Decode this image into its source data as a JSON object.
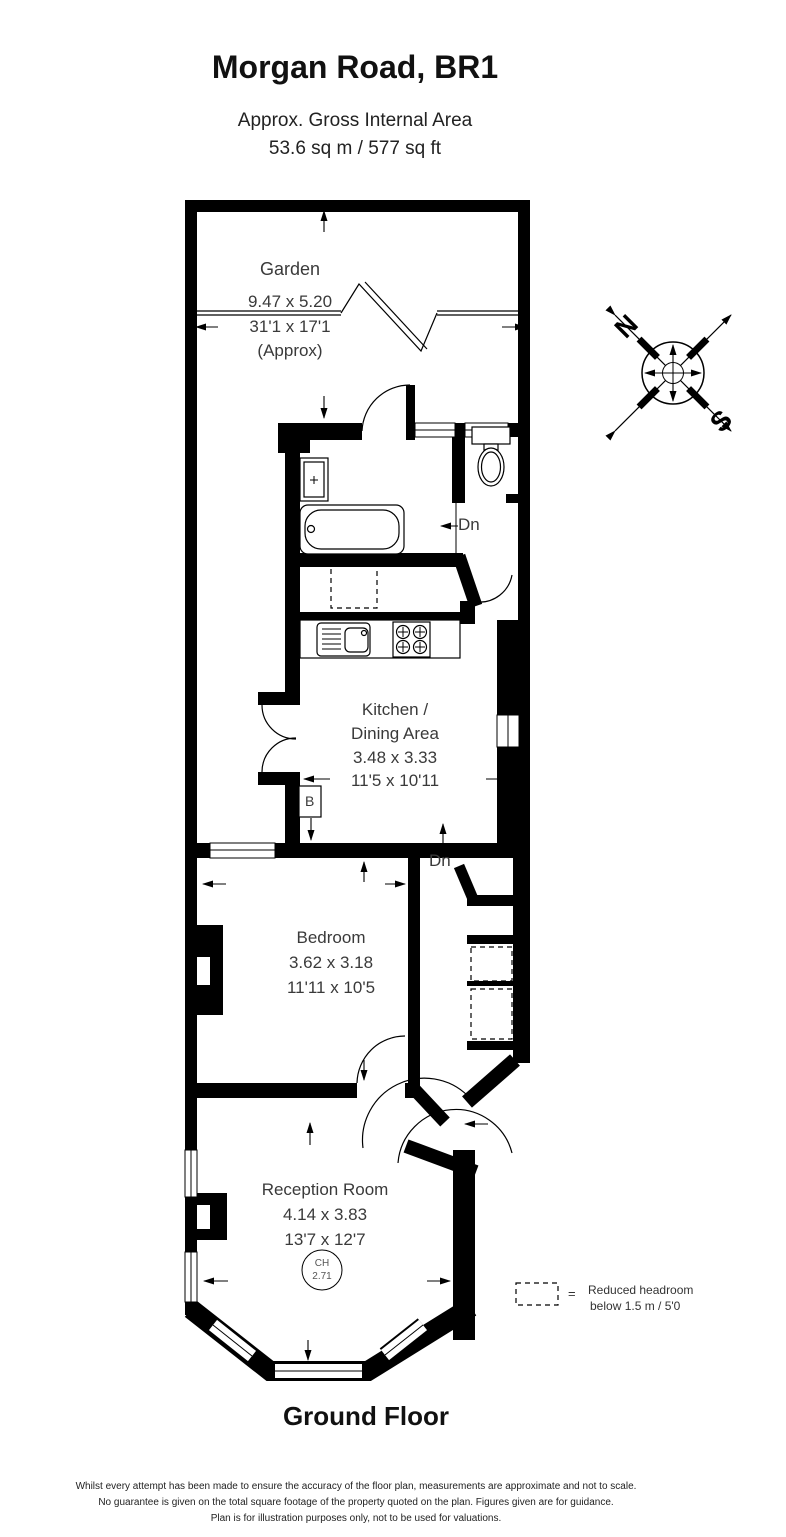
{
  "title": {
    "address": "Morgan Road, BR1",
    "area_label": "Approx. Gross Internal Area",
    "area_value": "53.6 sq m / 577 sq ft"
  },
  "rooms": {
    "garden": {
      "name": "Garden",
      "metric": "9.47 x 5.20",
      "imperial": "31'1 x 17'1",
      "note": "(Approx)"
    },
    "kitchen": {
      "name_line1": "Kitchen /",
      "name_line2": "Dining Area",
      "metric": "3.48 x 3.33",
      "imperial": "11'5 x 10'11"
    },
    "bedroom": {
      "name": "Bedroom",
      "metric": "3.62 x 3.18",
      "imperial": "11'11 x 10'5"
    },
    "reception": {
      "name": "Reception Room",
      "metric": "4.14 x 3.83",
      "imperial": "13'7 x 12'7"
    }
  },
  "annotations": {
    "down_upper": "Dn",
    "down_lower": "Dn",
    "boiler": "B",
    "ceiling_height_label": "CH",
    "ceiling_height_value": "2.71"
  },
  "compass": {
    "north": "N",
    "south": "S"
  },
  "legend": {
    "equals": "=",
    "line1": "Reduced headroom",
    "line2": "below 1.5 m / 5'0"
  },
  "floor_label": "Ground Floor",
  "disclaimer": {
    "line1": "Whilst every attempt has been made to ensure the accuracy of the floor plan, measurements are approximate and not to scale.",
    "line2": "No guarantee is given on the total square footage of the property quoted on the plan. Figures given are for guidance.",
    "line3": "Plan is for illustration purposes only, not to be used for valuations."
  },
  "colors": {
    "wall": "#000000",
    "text": "#3a3a3a"
  }
}
